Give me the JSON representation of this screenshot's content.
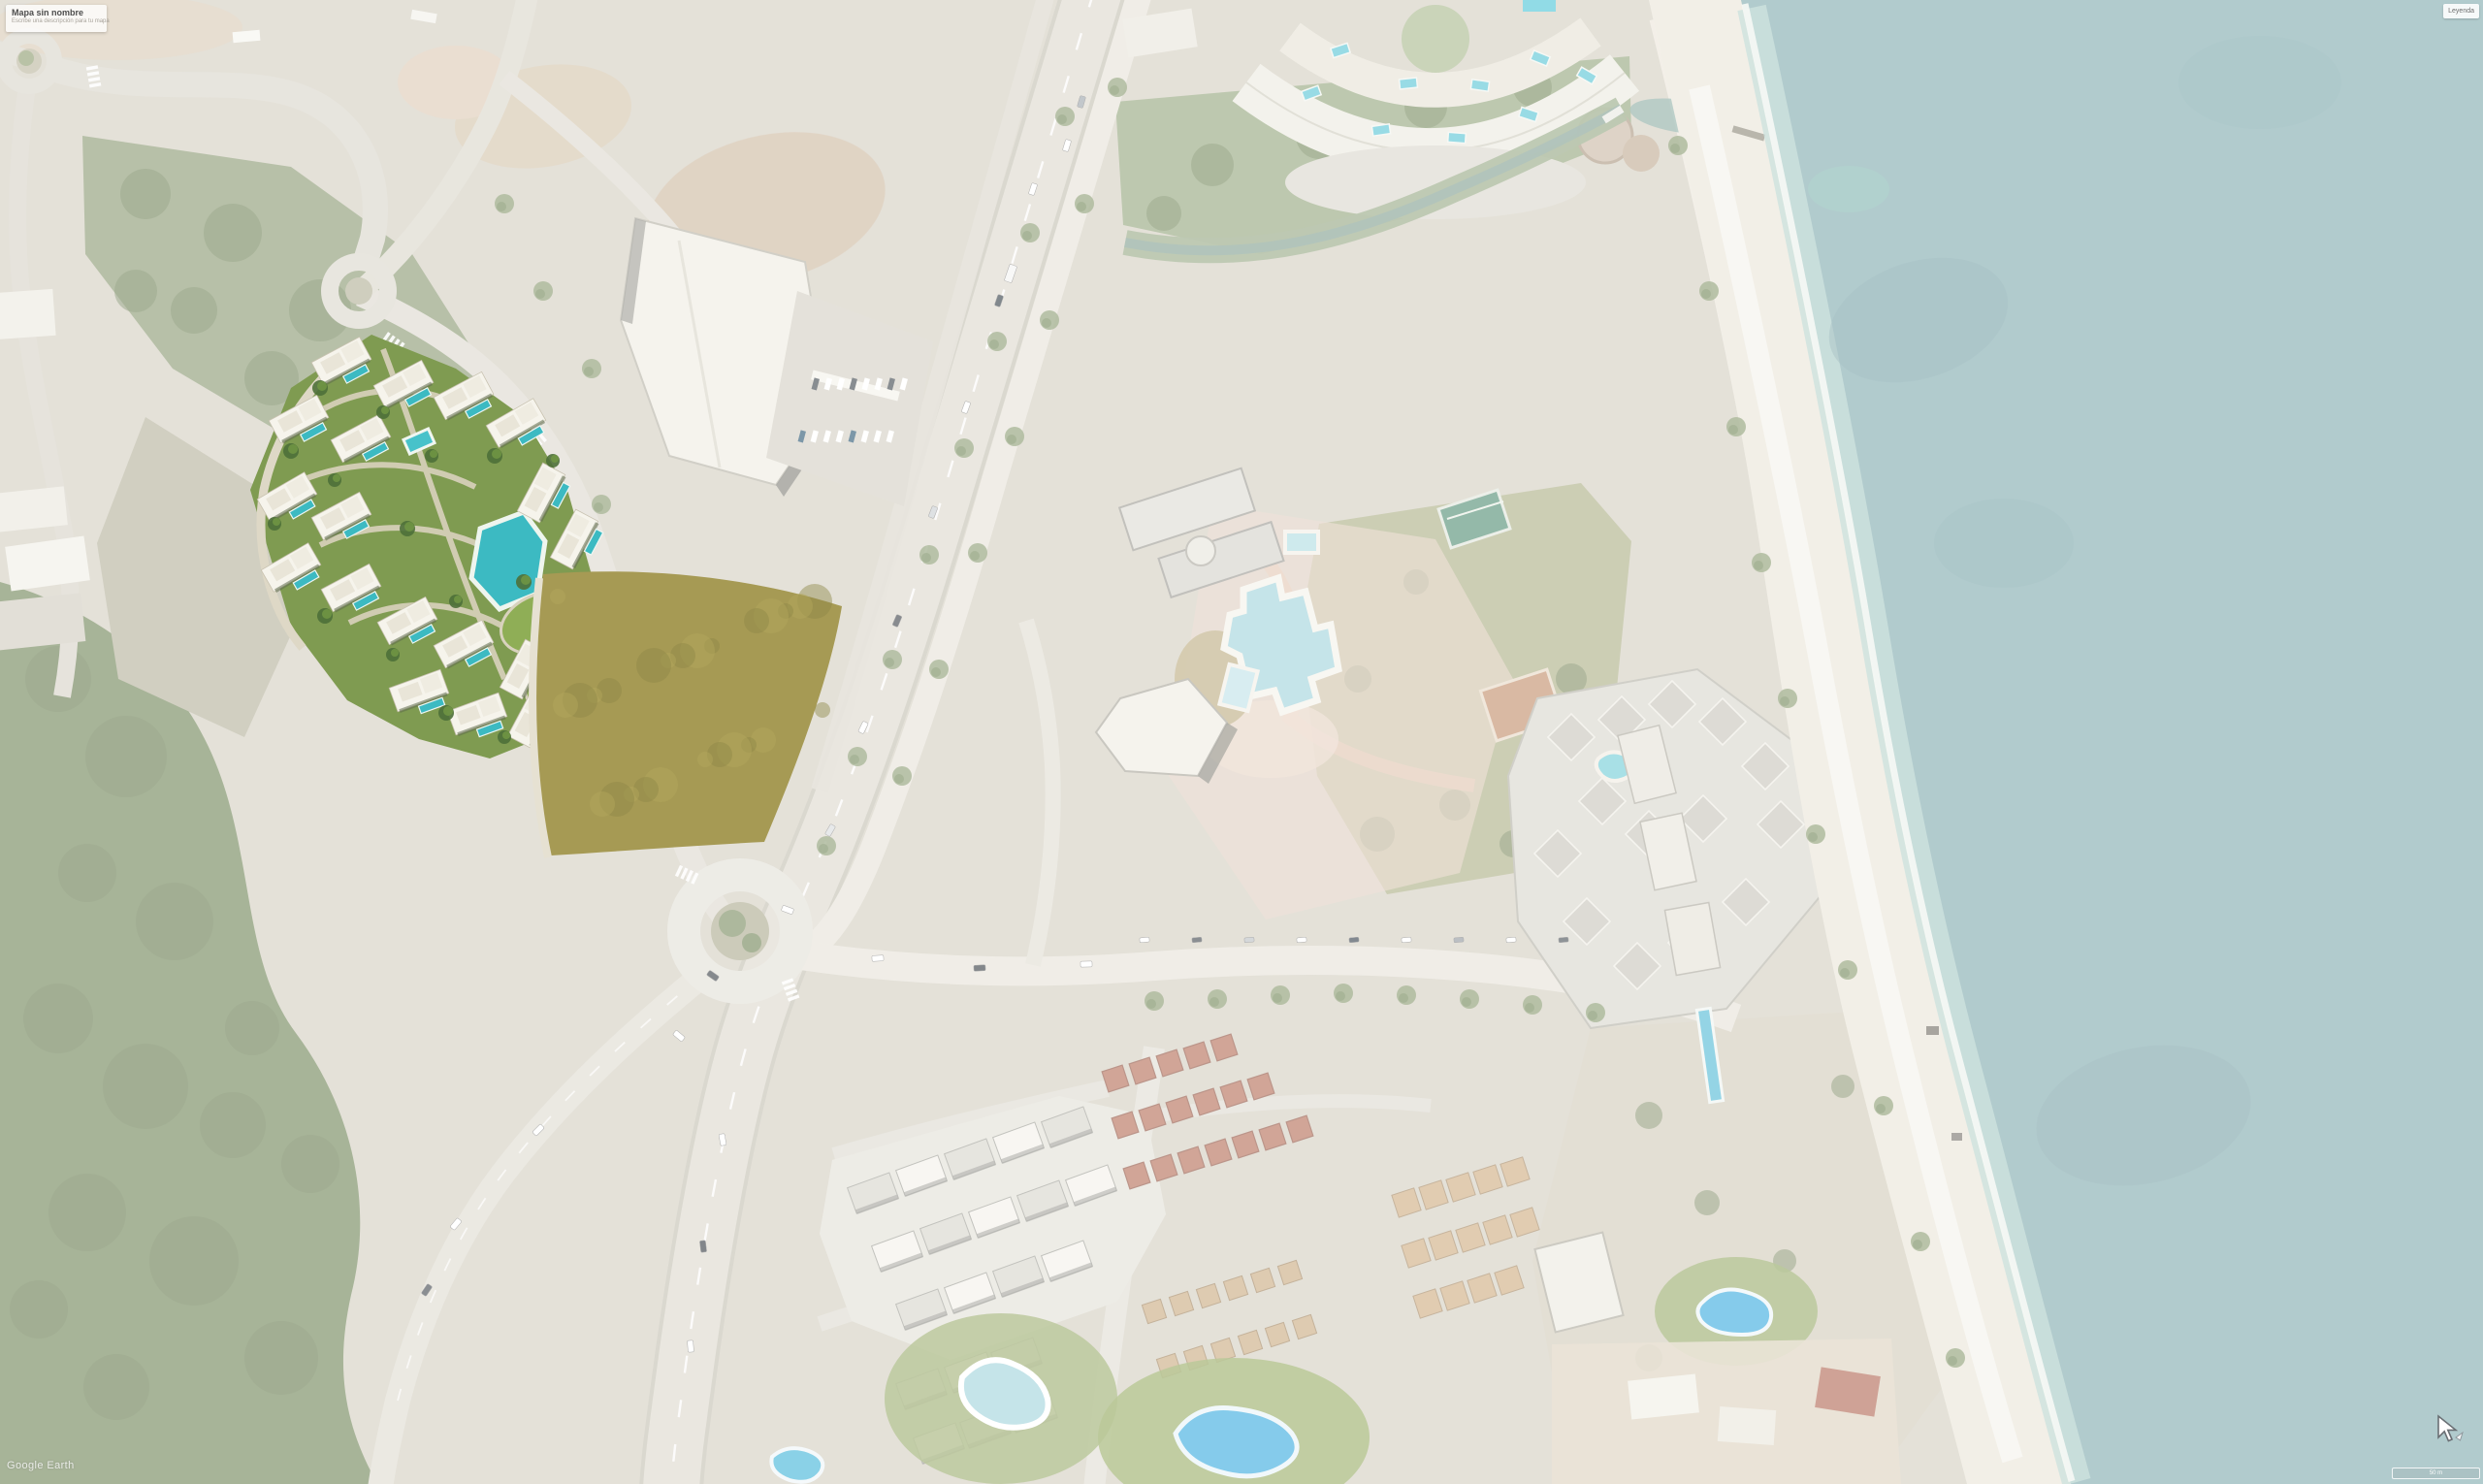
{
  "ui": {
    "title_card": {
      "title": "Mapa sin nombre",
      "subtitle": "Escribe una descripción para tu mapa"
    },
    "legend_button_label": "Leyenda",
    "watermark": "Google Earth",
    "scale_label": "50 m"
  },
  "map": {
    "view": "satellite-aerial",
    "features": [
      "sea",
      "beach",
      "coastal-resorts",
      "highway",
      "roundabouts",
      "residential-development-render",
      "vacant-field",
      "forest",
      "swimming-pools",
      "red-roof-townhouses"
    ],
    "colors": {
      "land": "#d2cdbf",
      "sea": "#7da8ac",
      "sea_deep": "#6f9ba0",
      "beach": "#eae5d8",
      "vegetation": "#7a8e5e",
      "forest": "#6d8254",
      "road": "#e6e2d7",
      "highway": "#dcd8cc",
      "render_lawn": "#7f9b51",
      "render_building": "#f6f4ec",
      "render_pool": "#3cbac2",
      "render_field": "#a69a54",
      "resort_pool": "#9fd2da",
      "bright_pool": "#35a9de",
      "red_roof": "#b26a52",
      "tan_roof": "#c8a87e",
      "path_pink": "#e6cfc0"
    }
  }
}
